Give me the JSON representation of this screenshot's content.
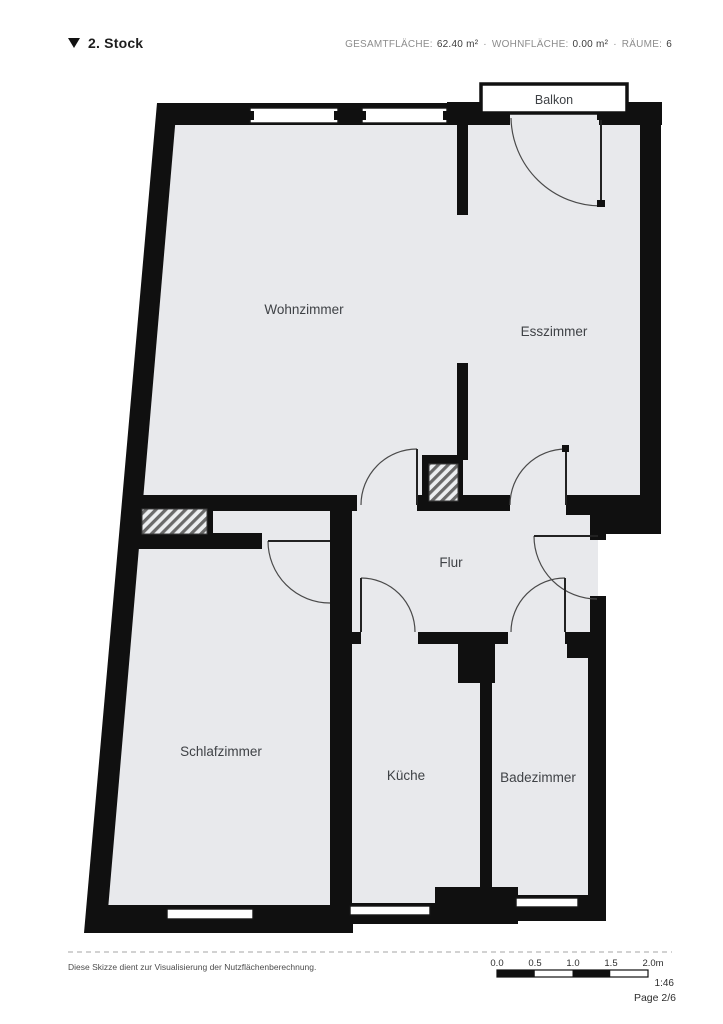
{
  "header": {
    "floor_label": "2. Stock",
    "stats": [
      {
        "label": "GESAMTFLÄCHE:",
        "value": "62.40 m²"
      },
      {
        "label": "WOHNFLÄCHE:",
        "value": "0.00 m²"
      },
      {
        "label": "RÄUME:",
        "value": "6"
      }
    ],
    "separator": "·"
  },
  "rooms": {
    "balkon": "Balkon",
    "wohnzimmer": "Wohnzimmer",
    "esszimmer": "Esszimmer",
    "flur": "Flur",
    "schlafzimmer": "Schlafzimmer",
    "kueche": "Küche",
    "badezimmer": "Badezimmer"
  },
  "footer": {
    "disclaimer": "Diese Skizze dient zur Visualisierung der Nutzflächenberechnung.",
    "scale_ticks": [
      "0.0",
      "0.5",
      "1.0",
      "1.5",
      "2.0m"
    ],
    "scale_ratio": "1:46",
    "page_number": "Page 2/6"
  },
  "colors": {
    "wall": "#101010",
    "floor": "#e8e9ec",
    "label": "#3f4246",
    "balcony_fill": "#ffffff"
  }
}
